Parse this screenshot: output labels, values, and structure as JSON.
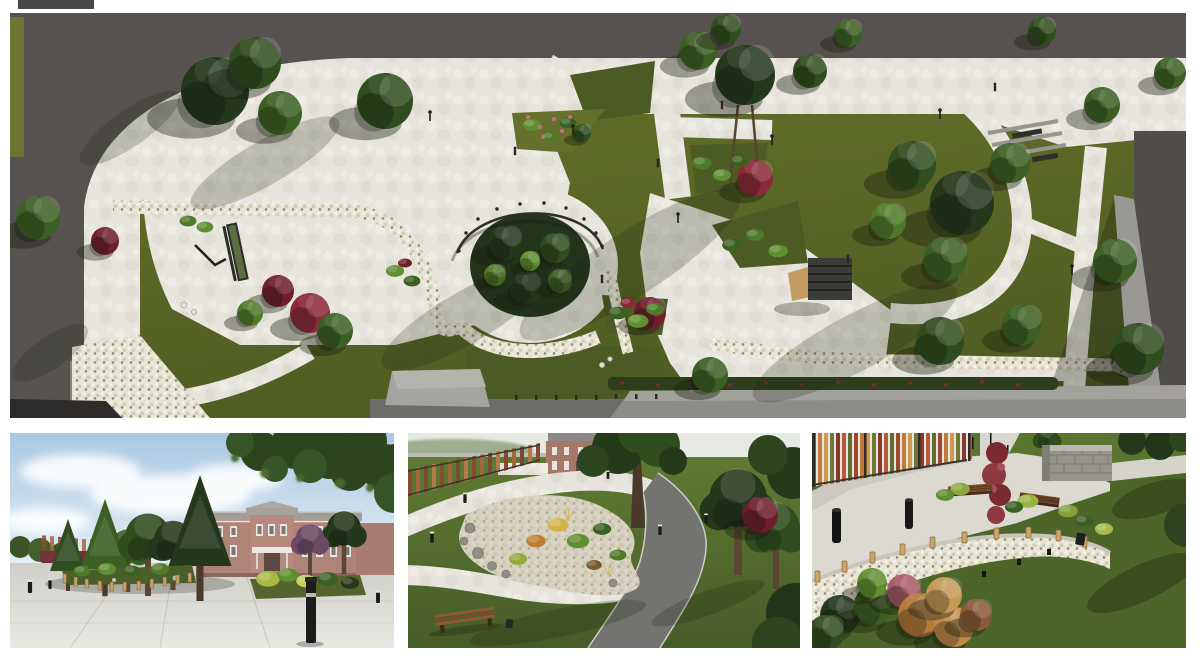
{
  "page": {
    "background": "#ffffff",
    "aria_label": "Landscape design presentation collage of four 3D renders of a park"
  },
  "panels": {
    "aerial": {
      "aria": "Aerial top view render of the park master plan with paths, circular planting bed and lawns"
    },
    "entrance": {
      "aria": "Street level render of paved entrance plaza, trees and two-story brick building"
    },
    "rock_garden": {
      "aria": "Elevated render of teardrop rock garden bed with looping gravel and asphalt paths"
    },
    "dry_garden": {
      "aria": "Elevated render of pebble planting bed with timber posts, benches and colorful slat screen"
    }
  },
  "palette": {
    "bg": "#ffffff",
    "road": "#565250",
    "pave": "#e4e2da",
    "lawn": "#64702c",
    "lawn-dark": "#4c5a23",
    "asphalt": "#737470",
    "brick": "#b08377",
    "roof": "#9b9894",
    "sky-top": "#a9c8e2",
    "sky-low": "#edf3f7",
    "tree-dark": "#24381b",
    "tree-mid": "#2f4d1f",
    "tree-light": "#4f7a2a",
    "shrub-maroon": "#6e1f2a",
    "wood": "#c9a56a",
    "metal-black": "#1c1c1a",
    "pebble": "#e7e4d4"
  }
}
